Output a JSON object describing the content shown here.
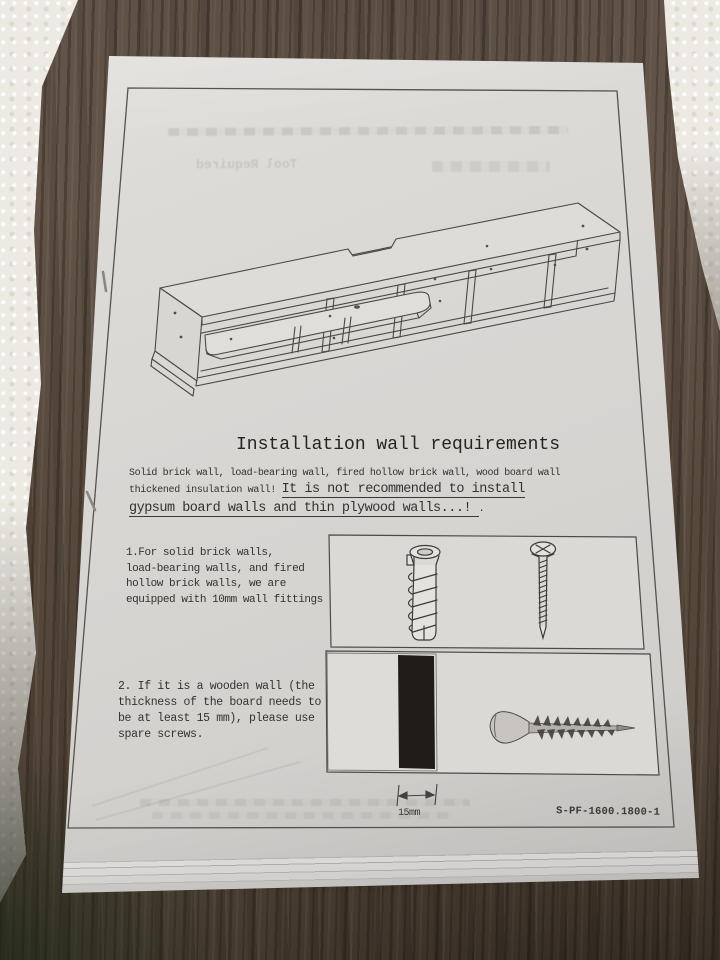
{
  "photo": {
    "surface": "dark wood-grain table",
    "packaging": "white styrofoam pieces at left edge and top-right corner",
    "item": "instruction-manual booklet page"
  },
  "colors": {
    "paper": "#d8d6d3",
    "wood": "#55483b",
    "ink": "#2d2c29",
    "board_swatch": "#201c19",
    "styrofoam": "#eceae3"
  },
  "doc": {
    "title": "Installation wall requirements",
    "intro_line1": "Solid brick wall, load-bearing wall, fired hollow brick wall, wood board wall",
    "intro_line2_plain": "thickened insulation wall! ",
    "intro_line2_underline": "It is not recommended to install",
    "intro_line3_underline": "gypsum board walls and thin plywood walls...! ",
    "intro_line3_tail": ".",
    "steps": [
      {
        "text": "1.For solid brick walls,\nload-bearing walls, and fired\nhollow brick walls, we are\nequipped with 10mm wall fittings"
      },
      {
        "text": "2. If it is a wooden wall (the\nthickness of the board needs to\nbe at least 15 mm), please use\nspare screws."
      }
    ],
    "dimension_label": "15mm",
    "model_number": "S-PF-1600.1800-1",
    "ghost_text": {
      "tool_required": "Tool Required"
    },
    "figures": {
      "main_illustration": "wall-mounted floating TV shelf, isometric line drawing",
      "hardware_box_1": [
        "expansion wall plug (10mm)",
        "mounting screw"
      ],
      "hardware_box_2": [
        "wood board cross-section (15mm)",
        "spare wood screw"
      ]
    }
  }
}
